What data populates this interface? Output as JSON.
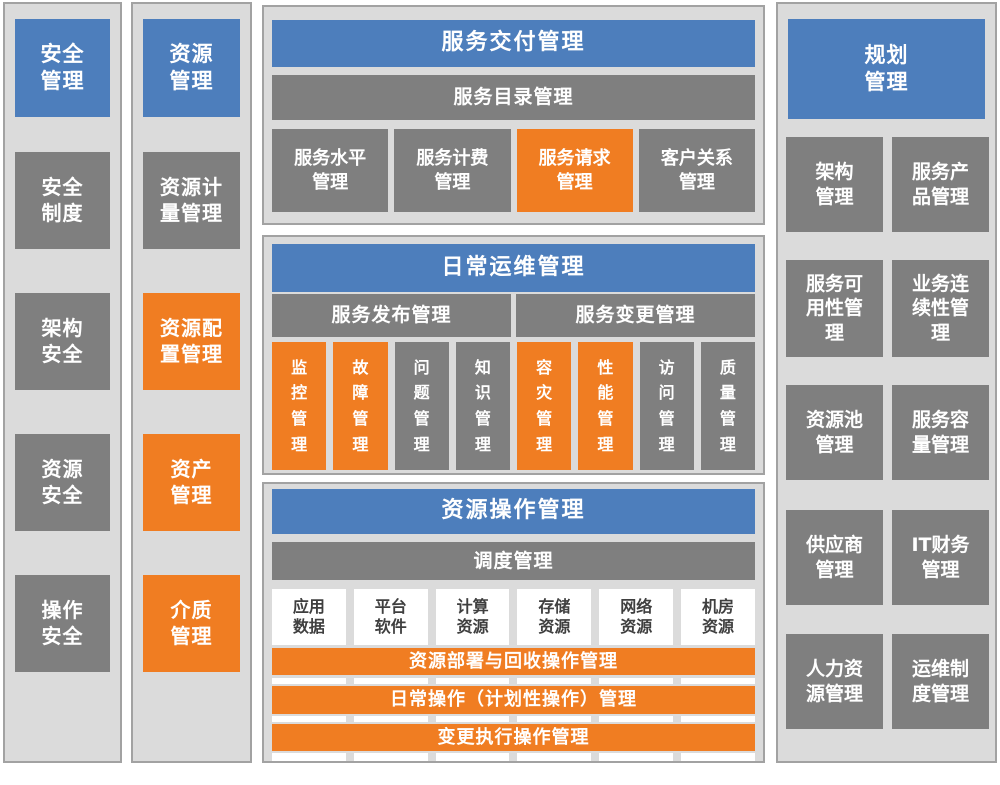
{
  "colors": {
    "blue": "#4D7EBC",
    "gray": "#7F7F7F",
    "orange": "#F07D22",
    "panel_bg": "#DBDBDB",
    "panel_border": "#A2A2A2",
    "white_box_text": "#3F3F3F"
  },
  "security": {
    "title": "安全\n管理",
    "items": [
      {
        "label": "安全\n制度",
        "color": "gray"
      },
      {
        "label": "架构\n安全",
        "color": "gray"
      },
      {
        "label": "资源\n安全",
        "color": "gray"
      },
      {
        "label": "操作\n安全",
        "color": "gray"
      }
    ]
  },
  "resource": {
    "title": "资源\n管理",
    "items": [
      {
        "label": "资源计\n量管理",
        "color": "gray"
      },
      {
        "label": "资源配\n置管理",
        "color": "orange"
      },
      {
        "label": "资产\n管理",
        "color": "orange"
      },
      {
        "label": "介质\n管理",
        "color": "orange"
      }
    ]
  },
  "service_delivery": {
    "title": "服务交付管理",
    "catalog_bar": "服务目录管理",
    "items": [
      {
        "label": "服务水平\n管理",
        "color": "gray"
      },
      {
        "label": "服务计费\n管理",
        "color": "gray"
      },
      {
        "label": "服务请求\n管理",
        "color": "orange"
      },
      {
        "label": "客户关系\n管理",
        "color": "gray"
      }
    ]
  },
  "daily_ops": {
    "title": "日常运维管理",
    "bars": [
      {
        "label": "服务发布管理"
      },
      {
        "label": "服务变更管理"
      }
    ],
    "items": [
      {
        "label": "监控管理",
        "color": "orange"
      },
      {
        "label": "故障管理",
        "color": "orange"
      },
      {
        "label": "问题管理",
        "color": "gray"
      },
      {
        "label": "知识管理",
        "color": "gray"
      },
      {
        "label": "容灾管理",
        "color": "orange"
      },
      {
        "label": "性能管理",
        "color": "orange"
      },
      {
        "label": "访问管理",
        "color": "gray"
      },
      {
        "label": "质量管理",
        "color": "gray"
      }
    ]
  },
  "resource_ops": {
    "title": "资源操作管理",
    "schedule_bar": "调度管理",
    "resources": [
      {
        "label": "应用\n数据"
      },
      {
        "label": "平台\n软件"
      },
      {
        "label": "计算\n资源"
      },
      {
        "label": "存储\n资源"
      },
      {
        "label": "网络\n资源"
      },
      {
        "label": "机房\n资源"
      }
    ],
    "bands": [
      {
        "label": "资源部署与回收操作管理"
      },
      {
        "label": "日常操作（计划性操作）管理"
      },
      {
        "label": "变更执行操作管理"
      }
    ]
  },
  "planning": {
    "title": "规划\n管理",
    "items": [
      {
        "label": "架构\n管理",
        "color": "gray"
      },
      {
        "label": "服务产\n品管理",
        "color": "gray"
      },
      {
        "label": "服务可\n用性管\n理",
        "color": "gray"
      },
      {
        "label": "业务连\n续性管\n理",
        "color": "gray"
      },
      {
        "label": "资源池\n管理",
        "color": "gray"
      },
      {
        "label": "服务容\n量管理",
        "color": "gray"
      },
      {
        "label": "供应商\n管理",
        "color": "gray"
      },
      {
        "label": "IT财务\n管理",
        "color": "gray"
      },
      {
        "label": "人力资\n源管理",
        "color": "gray"
      },
      {
        "label": "运维制\n度管理",
        "color": "gray"
      }
    ]
  }
}
